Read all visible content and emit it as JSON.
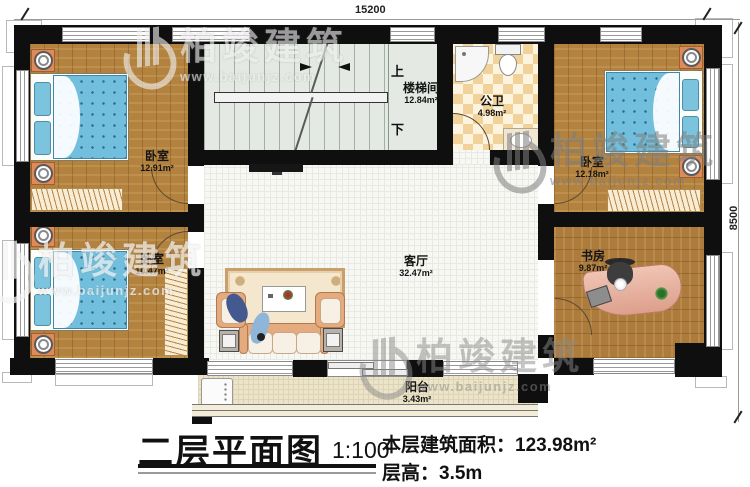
{
  "dimensions": {
    "width_mm": "15200",
    "height_mm": "8500"
  },
  "rooms": [
    {
      "key": "bedroom_top_left",
      "label": "卧室",
      "area": "12.91m²"
    },
    {
      "key": "bedroom_bottom_left",
      "label": "卧室",
      "area": "10.47m²"
    },
    {
      "key": "stairwell",
      "label": "楼梯间",
      "area": "12.84m²"
    },
    {
      "key": "bathroom",
      "label": "公卫",
      "area": "4.98m²"
    },
    {
      "key": "bedroom_top_right",
      "label": "卧室",
      "area": "12.18m²"
    },
    {
      "key": "living_room",
      "label": "客厅",
      "area": "32.47m²"
    },
    {
      "key": "study",
      "label": "书房",
      "area": "9.87m²"
    },
    {
      "key": "balcony",
      "label": "阳台",
      "area": "3.43m²"
    }
  ],
  "stairs": {
    "up": "上",
    "down": "下"
  },
  "title_block": {
    "title": "二层平面图",
    "scale": "1:100",
    "floor_area_label": "本层建筑面积：",
    "floor_area_value": "123.98m²",
    "floor_height_label": "层高：",
    "floor_height_value": "3.5m"
  },
  "watermark": {
    "brand": "柏竣建筑",
    "url": "www.baijunjz.com"
  },
  "colors": {
    "wall": "#0f0f0f",
    "wood": "#b3823f",
    "tile": "#f1d29a",
    "stair_floor": "#e4eae3",
    "living_floor": "#f7f7f4",
    "balcony_floor": "#ece4ca",
    "bed_blue": "#72bfdd",
    "nightstand_orange": "#e08a58"
  }
}
